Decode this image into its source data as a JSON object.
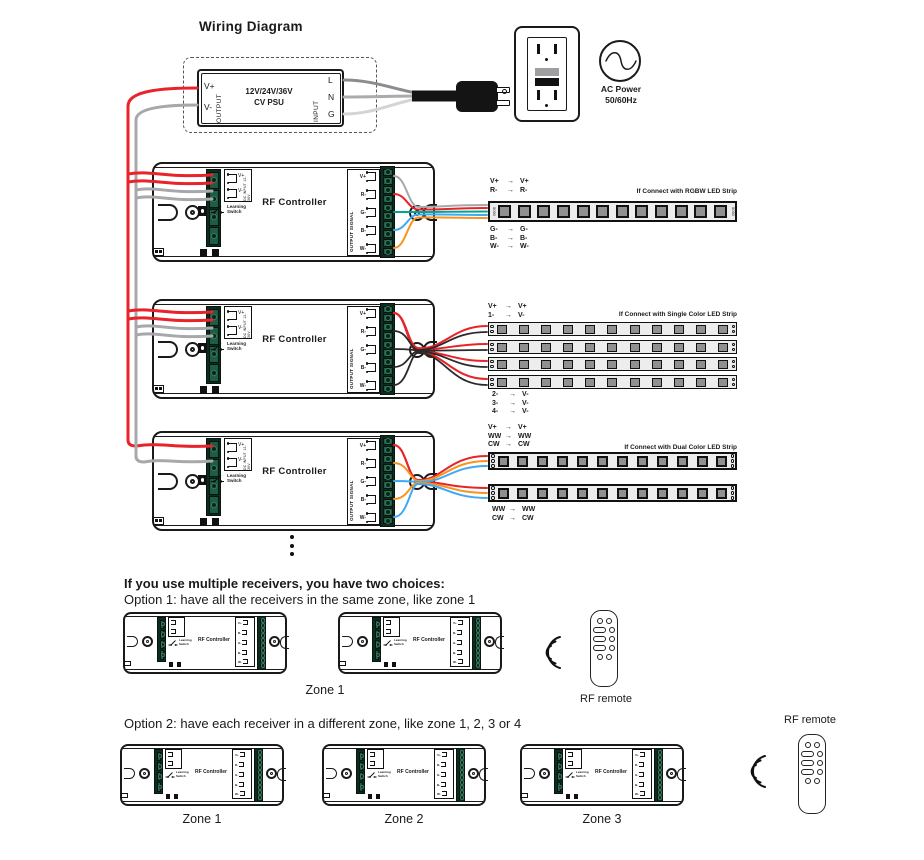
{
  "title": "Wiring Diagram",
  "symbols": {
    "arrow": "→"
  },
  "colors": {
    "wire_red": "#e8232a",
    "wire_gray": "#a6a8ab",
    "wire_light_gray": "#d2d4d6",
    "wire_dark_gray": "#8a8c8f",
    "wire_green": "#00a693",
    "wire_blue": "#3fa9f5",
    "wire_orange": "#f7941d",
    "wire_black": "#1a1a1a",
    "terminal_green": "#1d5c45",
    "strip_body": "#ededed"
  },
  "psu": {
    "output_label": "OUTPUT",
    "v_plus": "V+",
    "v_minus": "V-",
    "line1": "12V/24V/36V",
    "line2": "CV PSU",
    "input_label": "INPUT",
    "terminals": [
      "L",
      "N",
      "G"
    ]
  },
  "ac": {
    "line1": "AC Power",
    "line2": "50/60Hz"
  },
  "controller": {
    "name": "RF Controller",
    "dc_input": "DC INPUT 12-36V",
    "v_plus": "V+",
    "v_minus": "V-",
    "learning1": "Learning",
    "learning2": "Switch",
    "output_signal": "OUTPUT SIGNAL",
    "outputs": [
      "V+",
      "R-",
      "G-",
      "B-",
      "W-"
    ]
  },
  "rgbw": {
    "caption": "If Connect with RGBW LED Strip",
    "chip": "5050",
    "top": [
      {
        "f": "V+",
        "t": "V+"
      },
      {
        "f": "R-",
        "t": "R-"
      }
    ],
    "bottom": [
      {
        "f": "G-",
        "t": "G-"
      },
      {
        "f": "B-",
        "t": "B-"
      },
      {
        "f": "W-",
        "t": "W-"
      }
    ]
  },
  "single": {
    "caption": "If Connect with Single Color LED Strip",
    "top": [
      {
        "f": "V+",
        "t": "V+"
      },
      {
        "f": "1-",
        "t": "V-"
      }
    ],
    "bottom": [
      {
        "f": "2-",
        "t": "V-"
      },
      {
        "f": "3-",
        "t": "V-"
      },
      {
        "f": "4-",
        "t": "V-"
      }
    ]
  },
  "dual": {
    "caption": "If Connect with Dual Color LED Strip",
    "top": [
      {
        "f": "V+",
        "t": "V+"
      },
      {
        "f": "WW",
        "t": "WW"
      },
      {
        "f": "CW",
        "t": "CW"
      }
    ],
    "bottom": [
      {
        "f": "WW",
        "t": "WW"
      },
      {
        "f": "CW",
        "t": "CW"
      }
    ]
  },
  "notes": {
    "heading": "If you use multiple receivers, you have two choices:",
    "option1": "Option 1: have all the receivers in the same zone, like zone 1",
    "option2": "Option 2: have each receiver in a different zone, like zone 1, 2, 3 or 4"
  },
  "zones": {
    "option1": "Zone 1",
    "option2": [
      "Zone 1",
      "Zone 2",
      "Zone 3"
    ]
  },
  "remote": {
    "label": "RF remote"
  }
}
